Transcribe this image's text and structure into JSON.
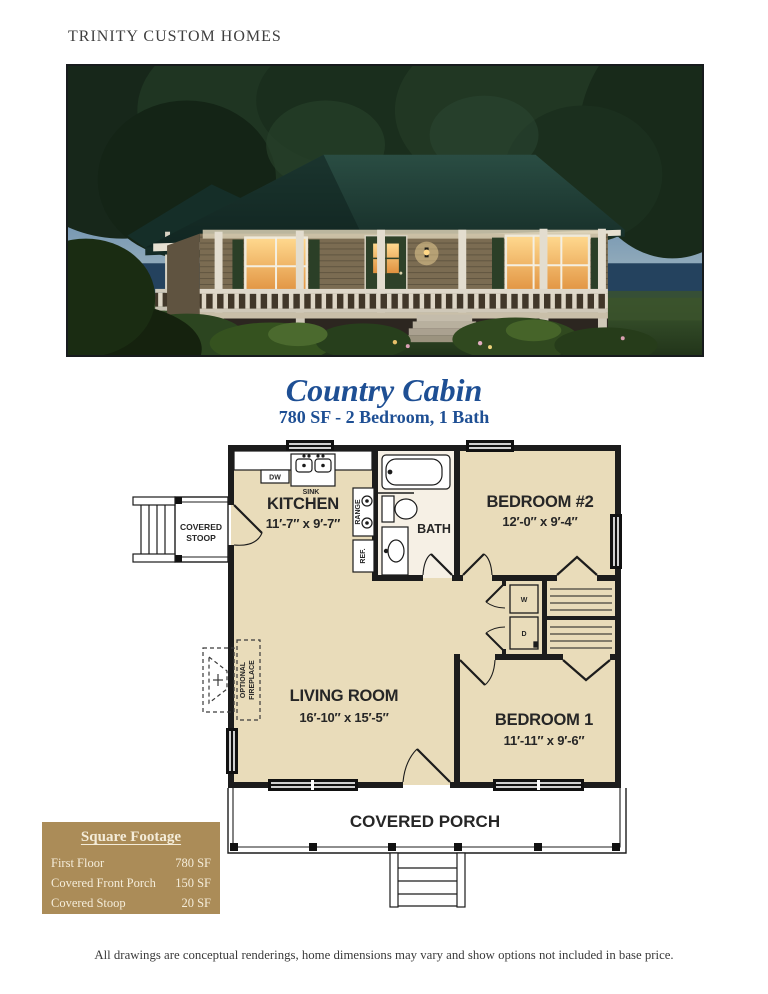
{
  "page": {
    "brand": "TRINITY CUSTOM HOMES",
    "disclaimer": "All drawings are conceptual renderings, home dimensions may vary and show options not included in base price."
  },
  "plan_header": {
    "title": "Country Cabin",
    "subtitle": "780 SF - 2 Bedroom, 1 Bath"
  },
  "colors": {
    "accent_blue": "#1e4f94",
    "table_gold": "#ab8c58",
    "floor_tan": "#e9dcba",
    "bath_floor": "#f6f0e5",
    "roof_green": "#1d3a33"
  },
  "floorplan": {
    "rooms": [
      {
        "name": "KITCHEN",
        "dims": "11′-7″ x 9′-7″"
      },
      {
        "name": "BEDROOM #2",
        "dims": "12′-0″ x 9′-4″"
      },
      {
        "name": "BATH",
        "dims": ""
      },
      {
        "name": "LIVING ROOM",
        "dims": "16′-10″ x 15′-5″"
      },
      {
        "name": "BEDROOM 1",
        "dims": "11′-11″ x 9′-6″"
      }
    ],
    "labels": {
      "covered_stoop": [
        "COVERED",
        "STOOP"
      ],
      "covered_porch": "COVERED PORCH",
      "optional_fireplace": [
        "OPTIONAL",
        "FIREPLACE"
      ],
      "dw": "DW",
      "sink": "SINK",
      "range": "RANGE",
      "ref": "REF.",
      "washer": "W",
      "dryer": "D"
    }
  },
  "square_footage": {
    "title": "Square Footage",
    "rows": [
      {
        "label": "First Floor",
        "value": "780 SF"
      },
      {
        "label": "Covered Front Porch",
        "value": "150 SF"
      },
      {
        "label": "Covered Stoop",
        "value": "20 SF"
      }
    ]
  }
}
